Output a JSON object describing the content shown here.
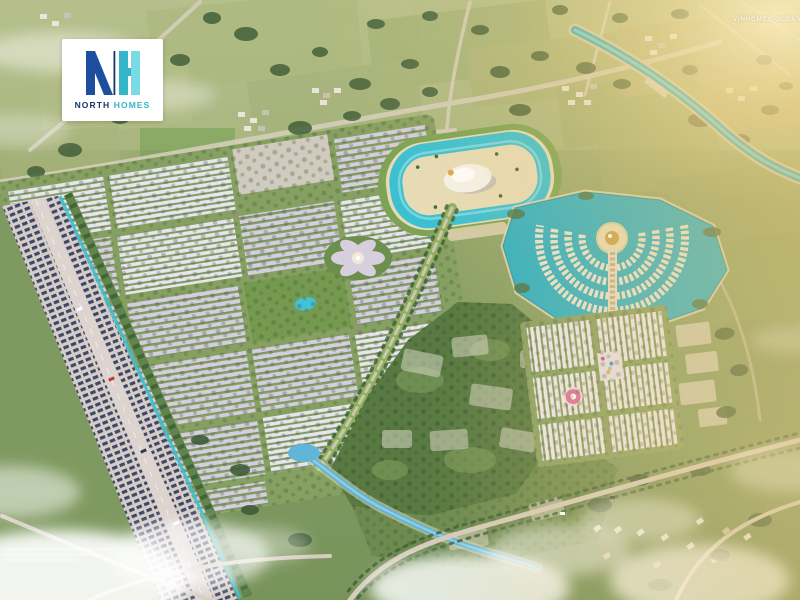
{
  "logo": {
    "monogram": {
      "n": "N",
      "h": "H"
    },
    "wordmark": {
      "first": "NORTH",
      "second": "HOMES"
    }
  },
  "watermarks": {
    "project": "VINHOMES OCEAN"
  },
  "theme": {
    "logo_navy": "#1d4f9e",
    "logo_dark_navy": "#16366b",
    "logo_teal": "#35b5c8",
    "logo_teal_light": "#79dbe6",
    "water_teal": "#2fb0c4",
    "lagoon_turquoise": "#38c0d4",
    "sand": "#e7dcb8",
    "panel_navy": "#2e3a5e",
    "road_gray": "#d6cdc7",
    "canal_blue": "#5fb6d9",
    "golden": "#e9c373",
    "landscape_green": "#8ea26a",
    "park_green": "#587a42",
    "rooftop_lavender": "#d4cede",
    "rooftop_white": "#e7e5ee"
  },
  "map": {
    "features": [
      {
        "name": "countryside-north"
      },
      {
        "name": "river-northeast"
      },
      {
        "name": "lagoon-waterpark"
      },
      {
        "name": "townhouse-estate-west"
      },
      {
        "name": "central-flower-plaza"
      },
      {
        "name": "fan-shaped-villa-island"
      },
      {
        "name": "townhouse-grid-southeast"
      },
      {
        "name": "forest-park"
      },
      {
        "name": "park-canal"
      },
      {
        "name": "western-boulevard"
      },
      {
        "name": "clouds"
      },
      {
        "name": "golden-sunlight"
      }
    ]
  }
}
